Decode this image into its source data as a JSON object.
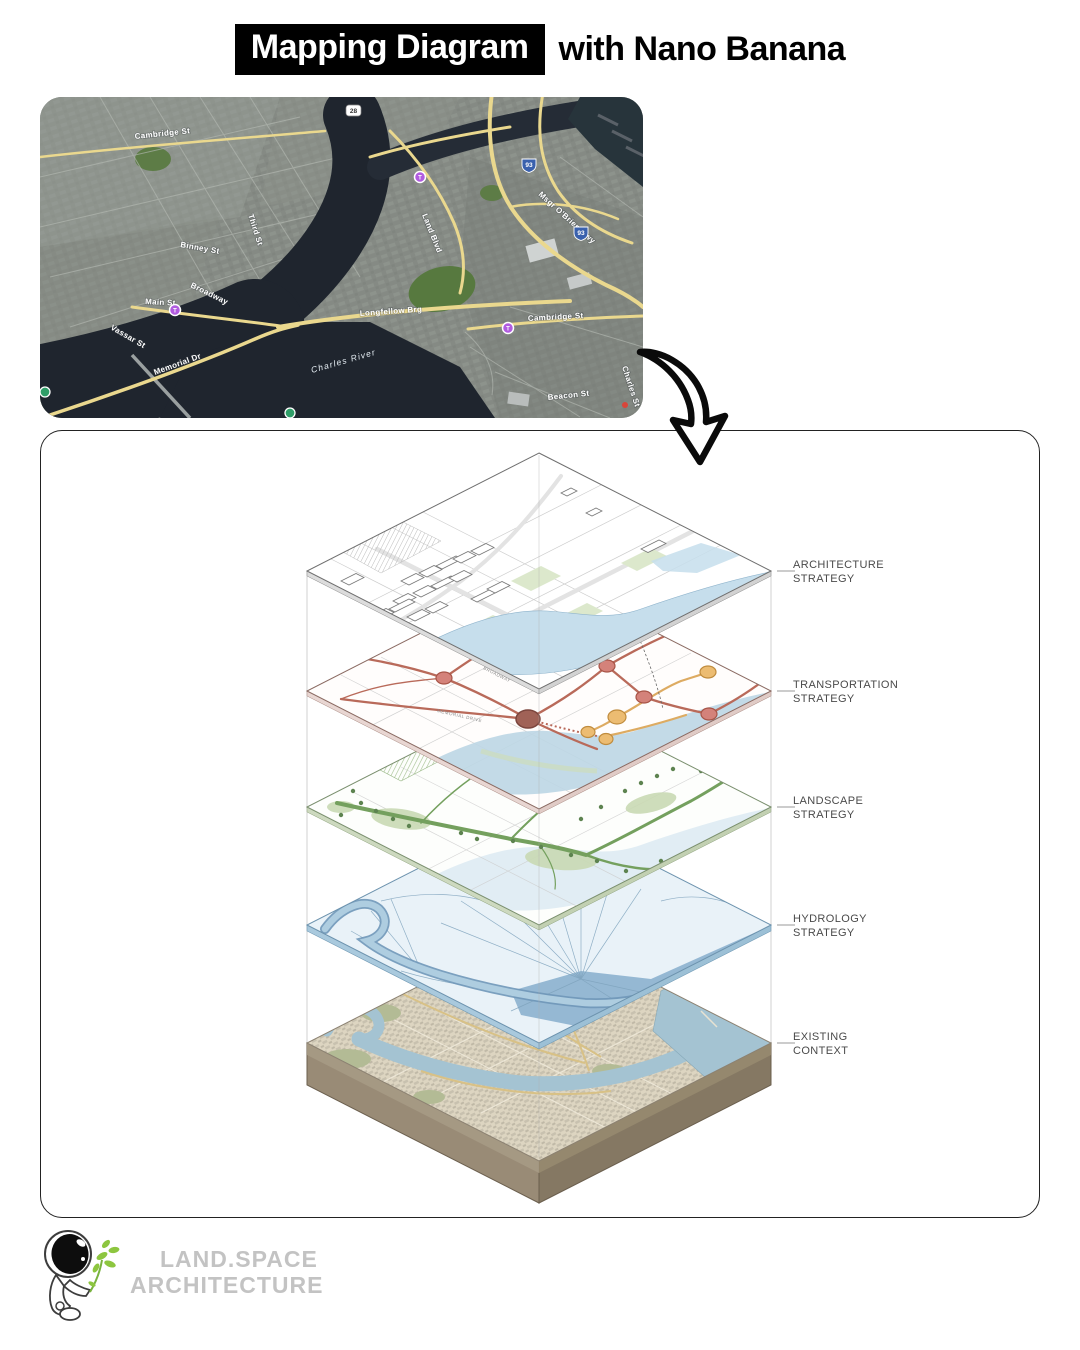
{
  "header": {
    "title_highlight": "Mapping Diagram",
    "title_rest": "with Nano Banana",
    "highlight_bg": "#000000",
    "highlight_fg": "#ffffff"
  },
  "satellite_map": {
    "street_labels": {
      "cambridge_st_left": "Cambridge St",
      "third_st": "Third St",
      "binney_st": "Binney St",
      "broadway": "Broadway",
      "main_st": "Main St",
      "vassar_st": "Vassar St",
      "memorial_dr": "Memorial Dr",
      "longfellow_brg": "Longfellow Brg",
      "charles_river": "Charles River",
      "land_blvd": "Land Blvd",
      "msgr_obrien_hwy": "Msgr O'Brien Hwy",
      "cambridge_st_right": "Cambridge St",
      "beacon_st": "Beacon St",
      "charles_st": "Charles St"
    },
    "highway_shields": {
      "i93_a": "93",
      "i93_b": "93",
      "route28": "28"
    },
    "marker_colors": {
      "transit_purple": "#b15be0",
      "transit_green": "#2f9e68",
      "poi_red": "#d9453a"
    },
    "water_color": "#1f252e",
    "road_color": "#ead88e"
  },
  "diagram": {
    "layers": [
      {
        "id": "architecture",
        "label_line1": "ARCHITECTURE",
        "label_line2": "STRATEGY"
      },
      {
        "id": "transportation",
        "label_line1": "TRANSPORTATION",
        "label_line2": "STRATEGY"
      },
      {
        "id": "landscape",
        "label_line1": "LANDSCAPE",
        "label_line2": "STRATEGY"
      },
      {
        "id": "hydrology",
        "label_line1": "HYDROLOGY",
        "label_line2": "STRATEGY"
      },
      {
        "id": "existing",
        "label_line1": "EXISTING",
        "label_line2": "CONTEXT"
      }
    ],
    "micro_labels": {
      "broadway": "BROADWAY",
      "memorial_drive": "MEMORIAL DRIVE"
    },
    "accent_colors": {
      "transport_red": "#b96a5a",
      "transport_orange": "#e2ac62",
      "landscape_green": "#74a05e",
      "hydrology_blue": "#89b2d0",
      "context_tan": "#ddd5c1"
    }
  },
  "footer_logo": {
    "line1": "LAND.SPACE",
    "line2": "ARCHITECTURE",
    "plant_green": "#8dc63f",
    "text_color": "#c3c3c3"
  }
}
